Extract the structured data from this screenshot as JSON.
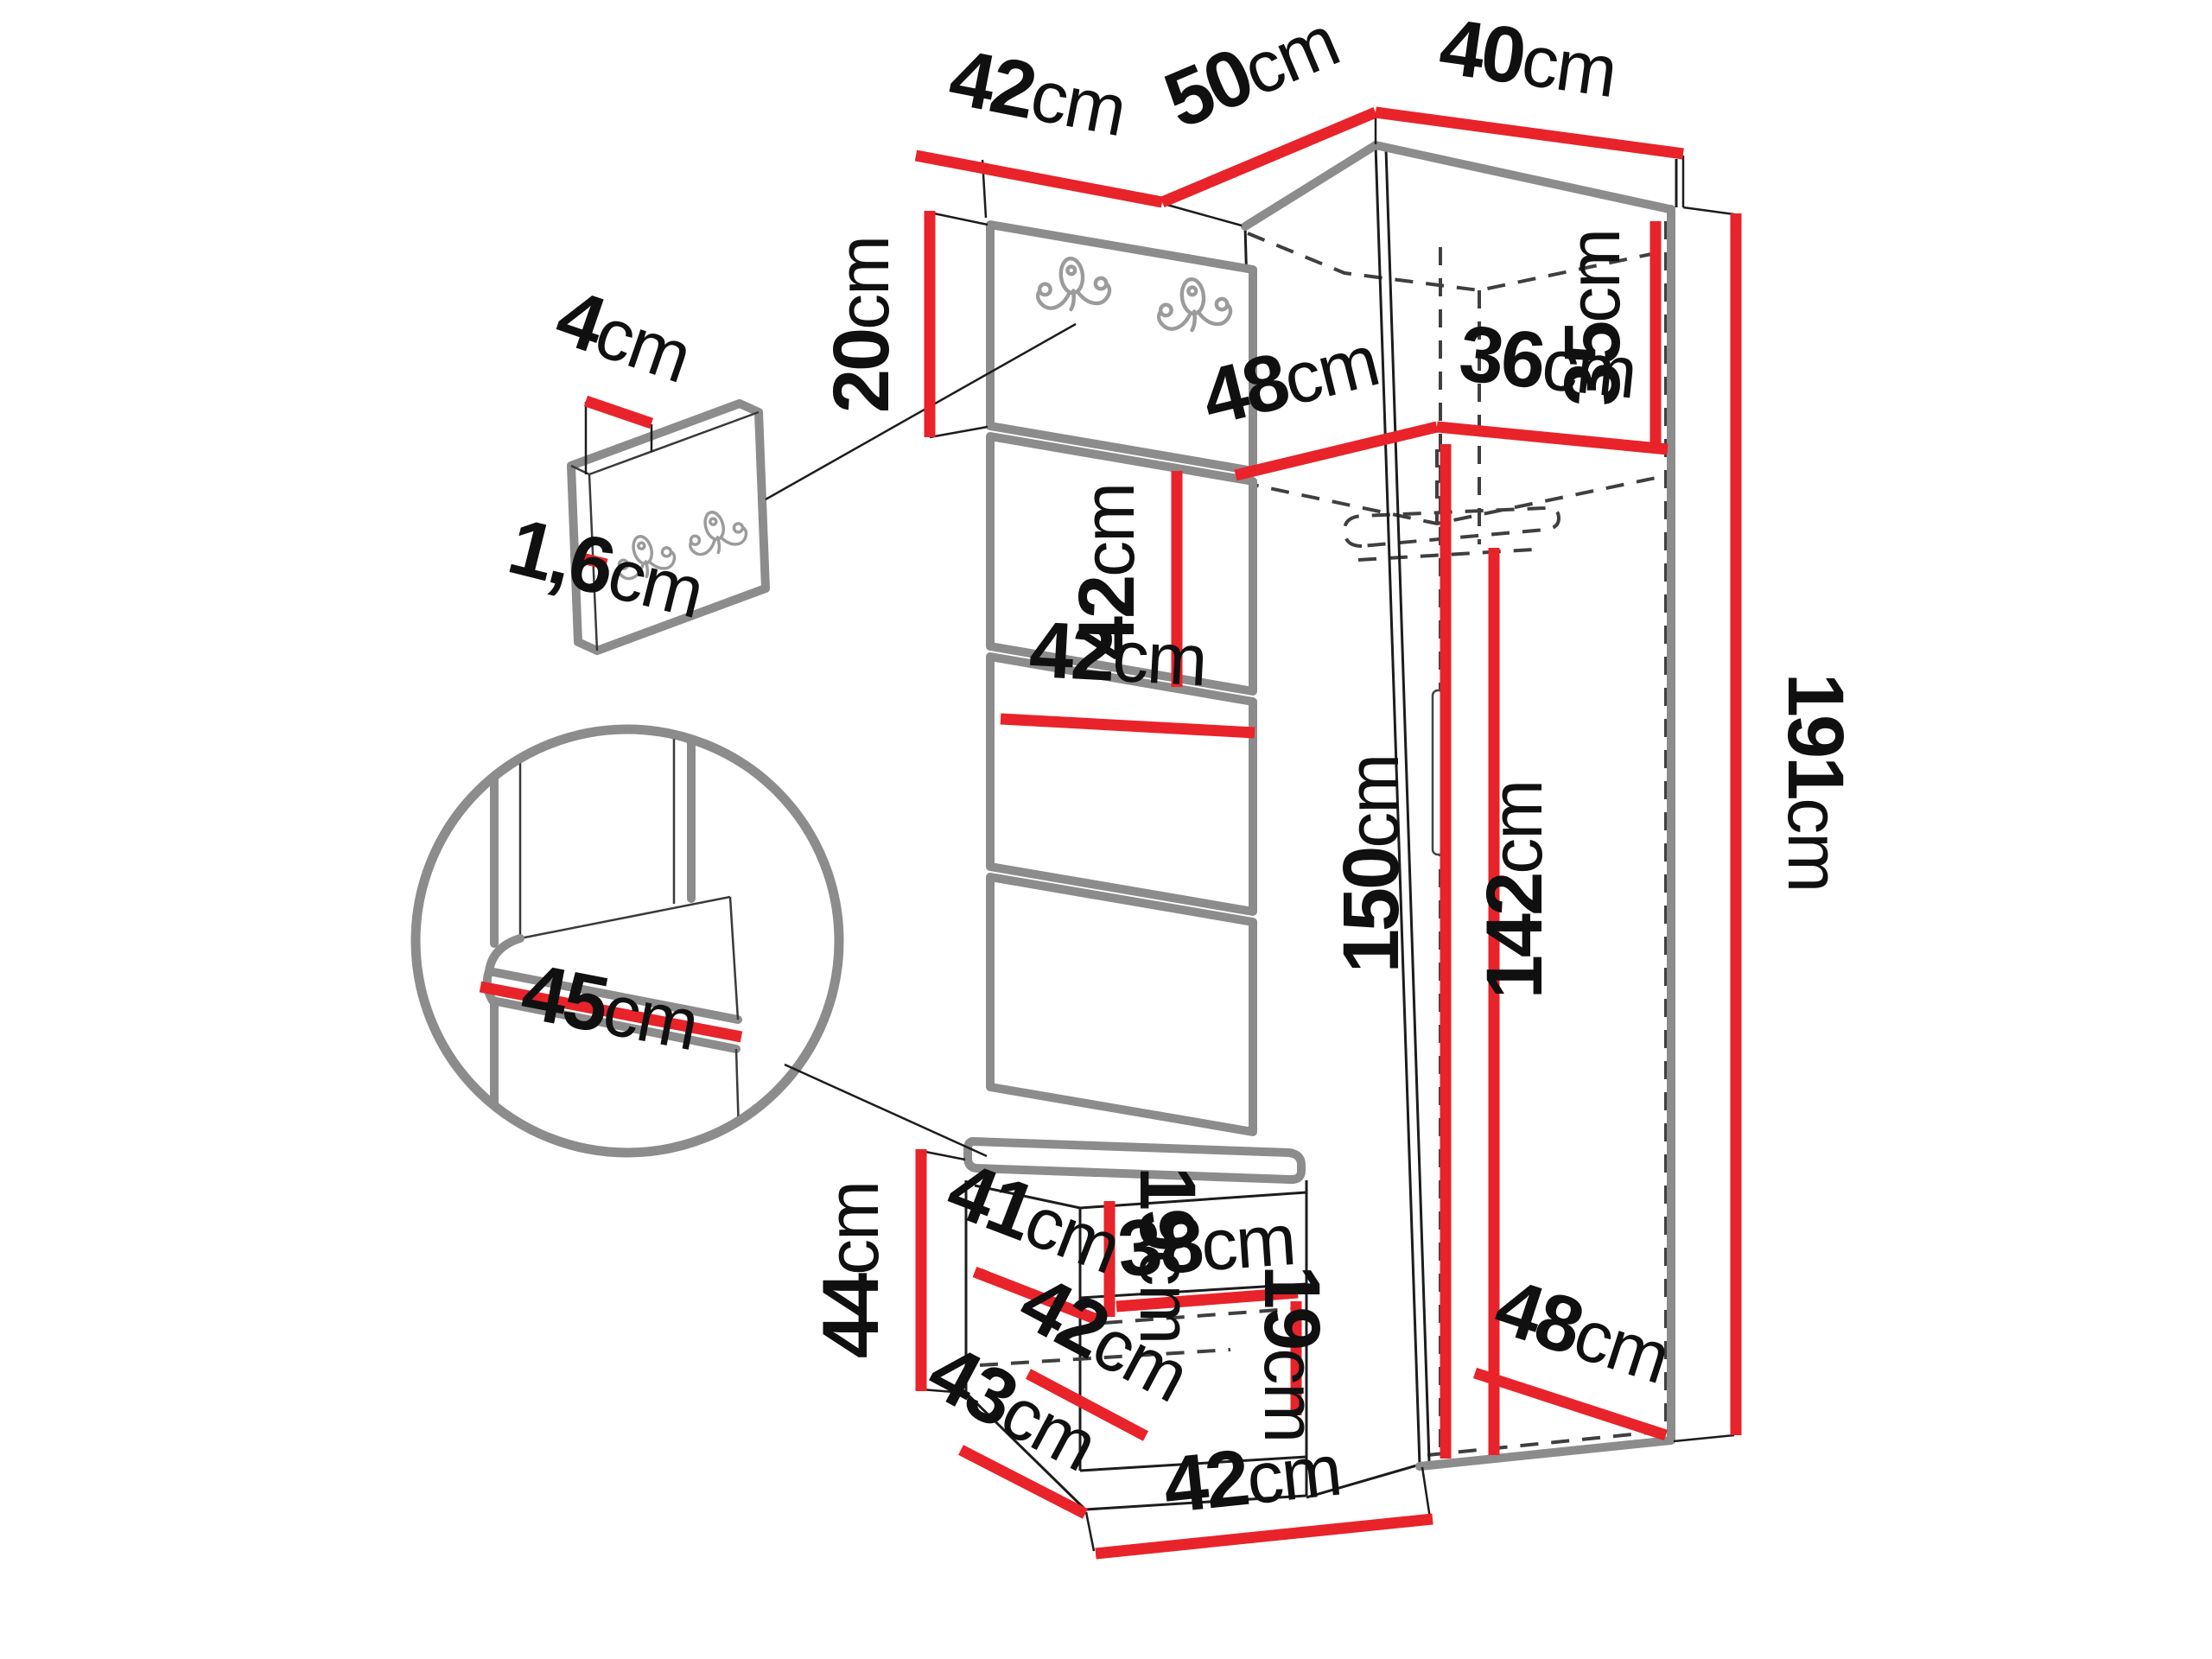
{
  "diagram": {
    "type": "furniture-dimension-drawing",
    "subject": "corner hallway wardrobe set with hook board, upholstered panels and shoe bench",
    "unit": "cm",
    "colors": {
      "background": "#ffffff",
      "dimension_accent": "#e8232a",
      "outline": "#1c1c1c",
      "shaded_edge": "#8c8c8c",
      "hidden_edge": "#3f3f3f",
      "label_text": "#101010"
    }
  },
  "dims": {
    "top_board_width": {
      "value": "42",
      "unit": "cm"
    },
    "corner_top_width": {
      "value": "50",
      "unit": "cm"
    },
    "right_top_width": {
      "value": "40",
      "unit": "cm"
    },
    "board_height": {
      "value": "20",
      "unit": "cm"
    },
    "pad_height": {
      "value": "42",
      "unit": "cm"
    },
    "top_shelf_depth": {
      "value": "48",
      "unit": "cm"
    },
    "top_shelf_width": {
      "value": "36",
      "unit": "cm"
    },
    "top_niche_height": {
      "value": "35",
      "unit": "cm"
    },
    "pad_width": {
      "value": "42",
      "unit": "cm"
    },
    "interior_height": {
      "value": "150",
      "unit": "cm"
    },
    "hanging_height": {
      "value": "142",
      "unit": "cm"
    },
    "total_height": {
      "value": "191",
      "unit": "cm"
    },
    "bottom_depth": {
      "value": "48",
      "unit": "cm"
    },
    "bench_height": {
      "value": "44",
      "unit": "cm"
    },
    "bench_shelf_depth": {
      "value": "41",
      "unit": "cm"
    },
    "upper_compartment_height": {
      "value": "19",
      "unit": "cm"
    },
    "bench_shelf_width": {
      "value": "38",
      "unit": "cm"
    },
    "bench_inner_width": {
      "value": "42",
      "unit": "cm"
    },
    "lower_compartment_height": {
      "value": "19",
      "unit": "cm"
    },
    "bench_depth": {
      "value": "43",
      "unit": "cm"
    },
    "bench_width": {
      "value": "42",
      "unit": "cm"
    },
    "panel_thickness": {
      "value": "4",
      "unit": "cm"
    },
    "board_core_thickness": {
      "value": "1,6",
      "unit": "cm"
    },
    "seat_depth_detail": {
      "value": "45",
      "unit": "cm"
    }
  }
}
